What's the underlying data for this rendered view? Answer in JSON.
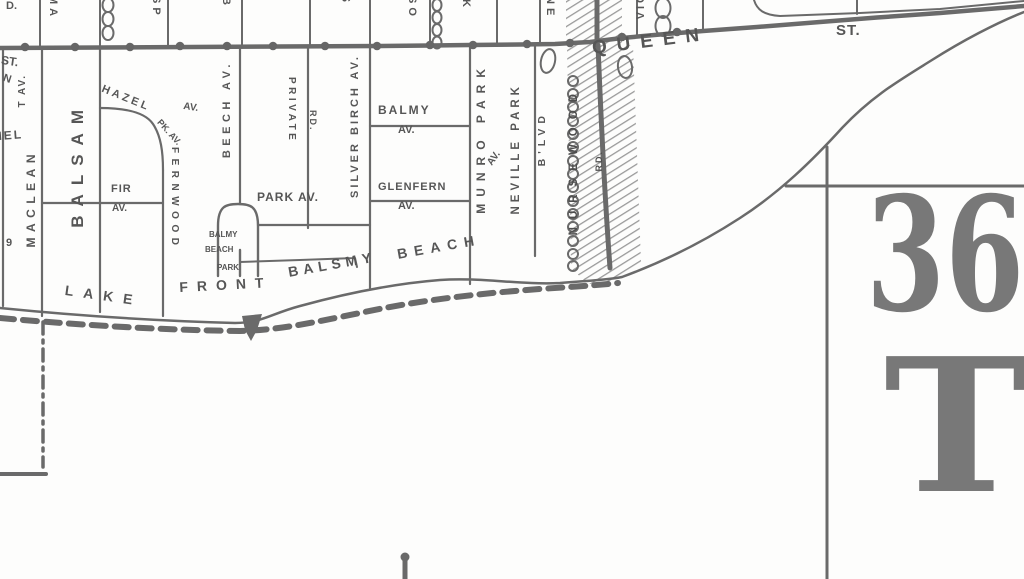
{
  "plate": {
    "number": "36",
    "letter": "T"
  },
  "queen_street": {
    "name": "QUEEN",
    "suffix": "ST."
  },
  "shoreline_text": {
    "lake": "LAKE",
    "front": "FRONT",
    "balmy": "BALSMY",
    "beach": "BEACH"
  },
  "streets": {
    "maclean": "MACLEAN",
    "balsam": "BALSAM",
    "hazel": "HAZEL",
    "hazel_av": "AV.",
    "fernwood_pk": "PK. AV.",
    "fernwood": "FERNWOOD",
    "fir": "FIR",
    "fir_av": "AV.",
    "beech": "BEECH AV.",
    "private_road": "PRIVATE",
    "private_rd": "RD.",
    "park_av": "PARK AV.",
    "balmy": "BALMY",
    "balmy_av": "AV.",
    "glenfern": "GLENFERN",
    "glenfern_av": "AV.",
    "silver_birch": "SILVER BIRCH AV.",
    "munro_park": "MUNRO PARK",
    "munro_av": "AV.",
    "neville_park": "NEVILLE PARK",
    "neville_blvd": "B'LVD",
    "nursewood": "NURSEWOOD",
    "nursewood_rd": "RD."
  },
  "park_label": {
    "line1": "BALMY",
    "line2": "BEACH",
    "line3": "PARK"
  },
  "edge_fragments": {
    "top_d": "D.",
    "ma": "MA",
    "sp": "SP",
    "b": "B",
    "s": "S",
    "so": "SO",
    "k": "K",
    "ne": "NE",
    "vic": "VIC",
    "left_st": "ST.",
    "left_n": "N",
    "left_t_av": "T AV.",
    "left_iel": "IEL",
    "left_num": "9"
  },
  "colors": {
    "ink": "#6a6a6a",
    "text": "#565656",
    "hatch": "#9a9a9a",
    "plate_text": "#787878"
  }
}
